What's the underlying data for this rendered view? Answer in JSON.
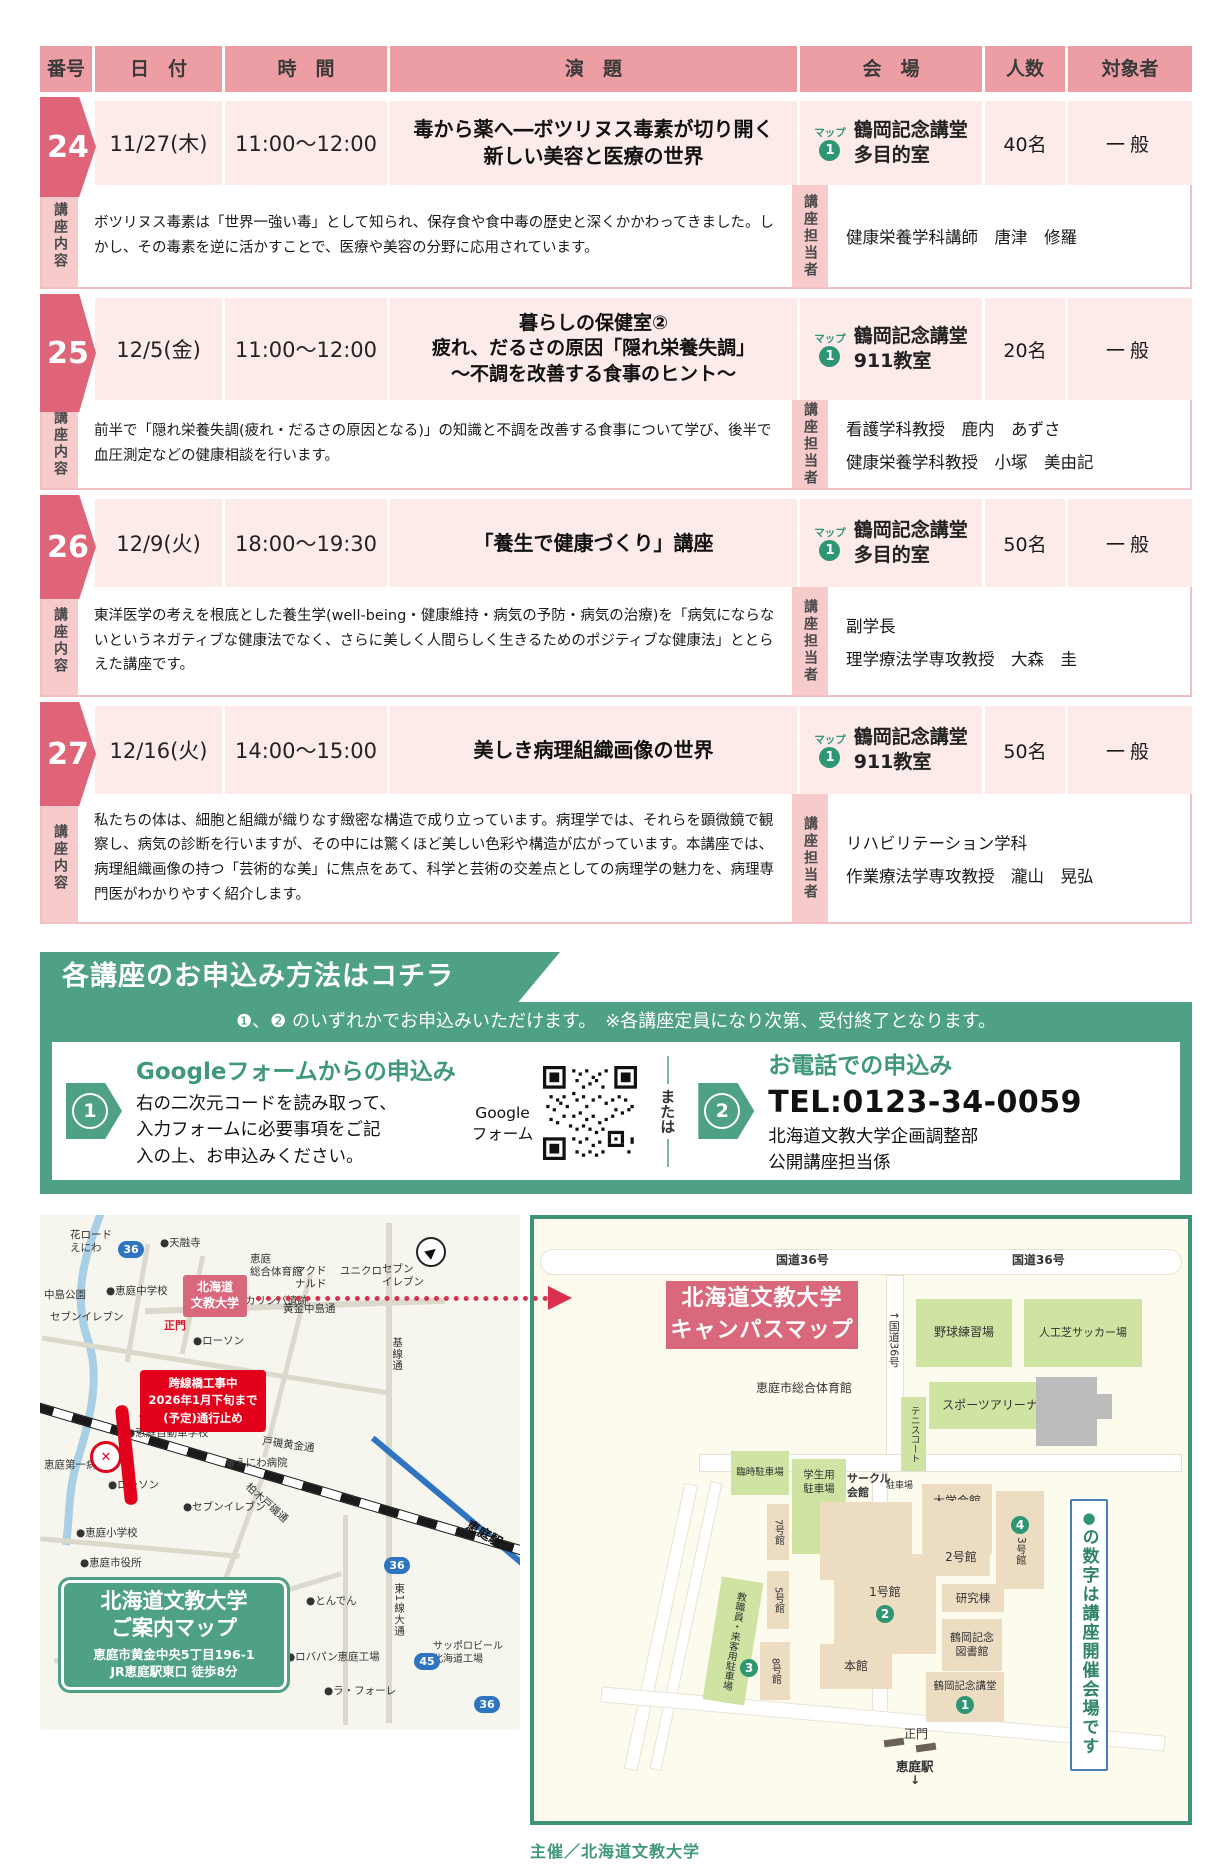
{
  "table": {
    "headers": {
      "number": "番号",
      "date": "日　付",
      "time": "時　間",
      "title": "演　題",
      "venue": "会　場",
      "capacity": "人数",
      "audience": "対象者"
    },
    "side_labels": {
      "content": "講座内容",
      "lecturer": "講座担当者"
    },
    "map_badge_label": "マップ",
    "rows": [
      {
        "number": "24",
        "date": "11/27(木)",
        "time": "11:00〜12:00",
        "title1": "毒から薬へ―ボツリヌス毒素が切り開く",
        "title2": "新しい美容と医療の世界",
        "map_no": "1",
        "venue1": "鶴岡記念講堂",
        "venue2": "多目的室",
        "capacity": "40名",
        "audience": "一般",
        "description": "ボツリヌス毒素は「世界一強い毒」として知られ、保存食や食中毒の歴史と深くかかわってきました。しかし、その毒素を逆に活かすことで、医療や美容の分野に応用されています。",
        "lecturer1": "健康栄養学科講師　唐津　修羅"
      },
      {
        "number": "25",
        "date": "12/5(金)",
        "time": "11:00〜12:00",
        "title1": "暮らしの保健室②",
        "title2": "疲れ、だるさの原因「隠れ栄養失調」",
        "title3": "〜不調を改善する食事のヒント〜",
        "map_no": "1",
        "venue1": "鶴岡記念講堂",
        "venue2": "911教室",
        "capacity": "20名",
        "audience": "一般",
        "description": "前半で「隠れ栄養失調(疲れ・だるさの原因となる)」の知識と不調を改善する食事について学び、後半で血圧測定などの健康相談を行います。",
        "lecturer1": "看護学科教授　鹿内　あずさ",
        "lecturer2": "健康栄養学科教授　小塚　美由記"
      },
      {
        "number": "26",
        "date": "12/9(火)",
        "time": "18:00〜19:30",
        "title1": "「養生で健康づくり」講座",
        "map_no": "1",
        "venue1": "鶴岡記念講堂",
        "venue2": "多目的室",
        "capacity": "50名",
        "audience": "一般",
        "description": "東洋医学の考えを根底とした養生学(well-being・健康維持・病気の予防・病気の治療)を「病気にならないというネガティブな健康法でなく、さらに美しく人間らしく生きるためのポジティブな健康法」ととらえた講座です。",
        "lecturer1": "副学長",
        "lecturer2": "理学療法学専攻教授　大森　圭"
      },
      {
        "number": "27",
        "date": "12/16(火)",
        "time": "14:00〜15:00",
        "title1": "美しき病理組織画像の世界",
        "map_no": "1",
        "venue1": "鶴岡記念講堂",
        "venue2": "911教室",
        "capacity": "50名",
        "audience": "一般",
        "description": "私たちの体は、細胞と組織が織りなす緻密な構造で成り立っています。病理学では、それらを顕微鏡で観察し、病気の診断を行いますが、その中には驚くほど美しい色彩や構造が広がっています。本講座では、病理組織画像の持つ「芸術的な美」に焦点をあて、科学と芸術の交差点としての病理学の魅力を、病理専門医がわかりやすく紹介します。",
        "lecturer1": "リハビリテーション学科",
        "lecturer2": "作業療法学専攻教授　瀧山　晃弘"
      }
    ]
  },
  "apply": {
    "banner": "各講座のお申込み方法はコチラ",
    "note": "❶、❷ のいずれかでお申込みいただけます。　※各講座定員になり次第、受付終了となります。",
    "or_label": "または",
    "method1": {
      "number": "1",
      "title": "Googleフォームからの申込み",
      "body1": "右の二次元コードを読み取って、",
      "body2": "入力フォームに必要事項をご記",
      "body3": "入の上、お申込みください。",
      "qr_label": "Google\nフォーム"
    },
    "method2": {
      "number": "2",
      "title": "お電話での申込み",
      "tel": "TEL:0123-34-0059",
      "org1": "北海道文教大学企画調整部",
      "org2": "公開講座担当係"
    }
  },
  "maps": {
    "left": {
      "univ_box": "北海道\n文教大学",
      "construction": "跨線橋工事中\n2026年1月下旬まで\n(予定)通行止め",
      "crossing_mark": "✕",
      "compass": "▶",
      "info_box": {
        "l1": "北海道文教大学",
        "l2": "ご案内マップ",
        "l3": "恵庭市黄金中央5丁目196-1",
        "l4": "JR恵庭駅東口 徒歩8分"
      },
      "shields": {
        "s1": "36",
        "s2": "36",
        "s3": "45",
        "s4": "36"
      },
      "l": {
        "hanaroad": "花ロード\nえにわ",
        "tenyuji": "●天融寺",
        "nakajima": "中島公園",
        "sogotaiikukan": "恵庭\n総合体育館",
        "mcd": "マクド\nナルド",
        "uniqlo": "ユニクロ",
        "seven1": "セブン\nイレブン",
        "chugakko": "●恵庭中学校",
        "seven2": "セブンイレブン",
        "koganenakajima": "黄金中島通",
        "karinba": "カリンバ遺跡",
        "seimon": "正門",
        "lawson1": "●ローソン",
        "kisendori": "基線通",
        "jidoshagakko": "●恵庭自動車学校",
        "toisokogane": "戸磯黄金通",
        "eniwabyoin": "●えにわ病院",
        "daiichibyoin": "恵庭第一病院",
        "lawson2": "●ローソン",
        "seven3": "●セブンイレブン",
        "shogakko": "●恵庭小学校",
        "shiyakusho": "●恵庭市役所",
        "eniwaeki": "恵庭駅",
        "clark": "クラーク博士通り",
        "kashiwagi": "柏木戸磯通",
        "tonden": "●とんでん",
        "higashi1sen": "東1線大通",
        "robapan": "●ロバパン恵庭工場",
        "laforet": "●ラ・フォーレ",
        "sapporobeer": "サッポロビール\n北海道工場"
      }
    },
    "campus": {
      "title": "北海道文教大学\nキャンパスマップ",
      "road_label1": "国道36号",
      "road_label2": "国道36号",
      "road_side_label": "↑国道36号",
      "markers": {
        "m1": "1",
        "m2": "2",
        "m3": "3",
        "m4": "4"
      },
      "note_bullet": "●",
      "note_text": "の数字は講座開催会場です",
      "b": {
        "yakyu": "野球練習場",
        "soccer": "人工芝サッカー場",
        "arena": "スポーツアリーナ",
        "tennis": "テニスコート",
        "sogo": "恵庭市総合体育館",
        "rinji": "臨時駐車場",
        "gakusei": "学生用\n駐車場",
        "circleHall": "サークル\n会館",
        "parking": "駐車場",
        "daigaku": "大学会館",
        "b7": "7号館",
        "gym": "体育館",
        "b2": "2号館",
        "b3": "3号館",
        "b5": "5号館",
        "b1": "1号館",
        "kenkyu": "研究棟",
        "lib": "鶴岡記念\n図書館",
        "staffpark": "教職員・来客用駐車場",
        "b8": "8号館",
        "honkan": "本館",
        "kodo": "鶴岡記念講堂",
        "seimon": "正門",
        "eki": "恵庭駅",
        "ekiArrow": "↓"
      }
    }
  },
  "footer": "主催／北海道文教大学"
}
